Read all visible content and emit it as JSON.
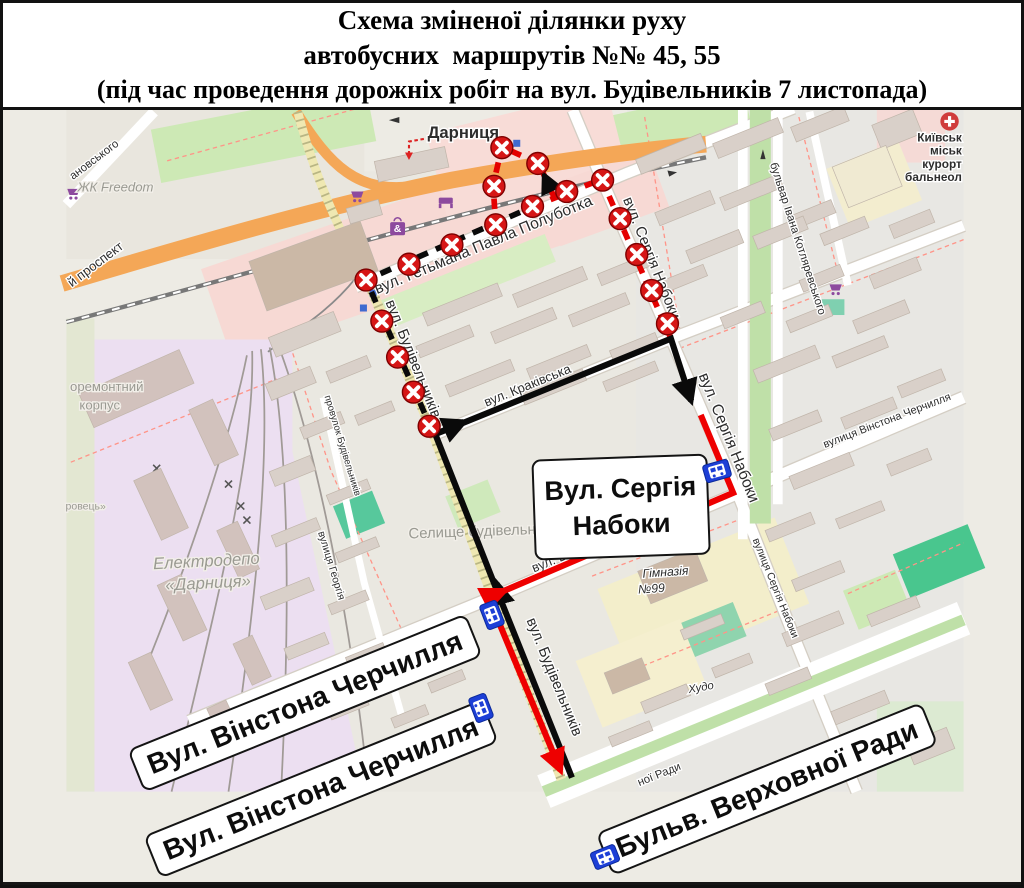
{
  "header": {
    "line1": "Схема зміненої ділянки руху",
    "line2": "автобусних  маршрутів №№ 45, 55",
    "line3": "(під час проведення дорожніх робіт на вул. Будівельників 7 листопада)"
  },
  "route_numbers": "45, 55",
  "boxes": {
    "naboky_line1": "Вул. Сергія",
    "naboky_line2": "Набоки",
    "churchill_upper": "Вул. Вінстона Черчилля",
    "churchill_lower": "Вул. Вінстона Черчилля",
    "verkhovna": "Бульв. Верховної Ради"
  },
  "labels": {
    "metro": "Дарниця",
    "zhk": "ЖК Freedom",
    "prospekt": "й проспект",
    "anovskoho": "ановського",
    "polubotka": "вул. Гетьмана Павла Полуботка",
    "krakivska": "вул. Краківська",
    "naboky_top": "вул. Сергія Набоки",
    "naboky_mid": "вул. Сергія Набоки",
    "naboky_small": "вулиця Сергія Набоки",
    "budiv_up": "вул. Будівельників",
    "budiv_low": "вул. Будівельників",
    "churchill_osm": "вул. Вінстона Черчилля",
    "churchill_right": "вулиця Вінстона Черчилля",
    "kotliarevskoho": "бульвар Івана Котляревського",
    "selyshche": "Селище будівельників",
    "himn1": "Гімназія",
    "himn2": "№99",
    "depo1": "Електродепо",
    "depo2": "«Дарниця»",
    "remont1": "оремонтний",
    "remont2": "корпус",
    "rovets": "ровець»",
    "khudo": "Худо",
    "heorhiia": "вулиця Георгія",
    "provulok": "провулок Будівельників",
    "rady": "ної Ради",
    "hosp1": "Київськ",
    "hosp2": "міськ",
    "hosp3": "курорт",
    "hosp4": "бальнеол"
  },
  "icons": {
    "bag_glyph": "&",
    "bus_stop": "bus-stop-icon",
    "closed_road": "x-marker-icon",
    "hospital": "red-cross-icon"
  },
  "colors": {
    "closed_section_black": "#0a0a0a",
    "closed_section_red": "#e40000",
    "detour_black": "#0a0a0a",
    "detour_red": "#ee0000",
    "x_marker": "#d61616",
    "bus_stop_blue": "#1d3fd6",
    "trunk_road_orange": "#f4a757",
    "park_green": "#cde9b5",
    "commercial_pink": "#f7d9d4",
    "industrial_lavender": "#ecdff1"
  }
}
